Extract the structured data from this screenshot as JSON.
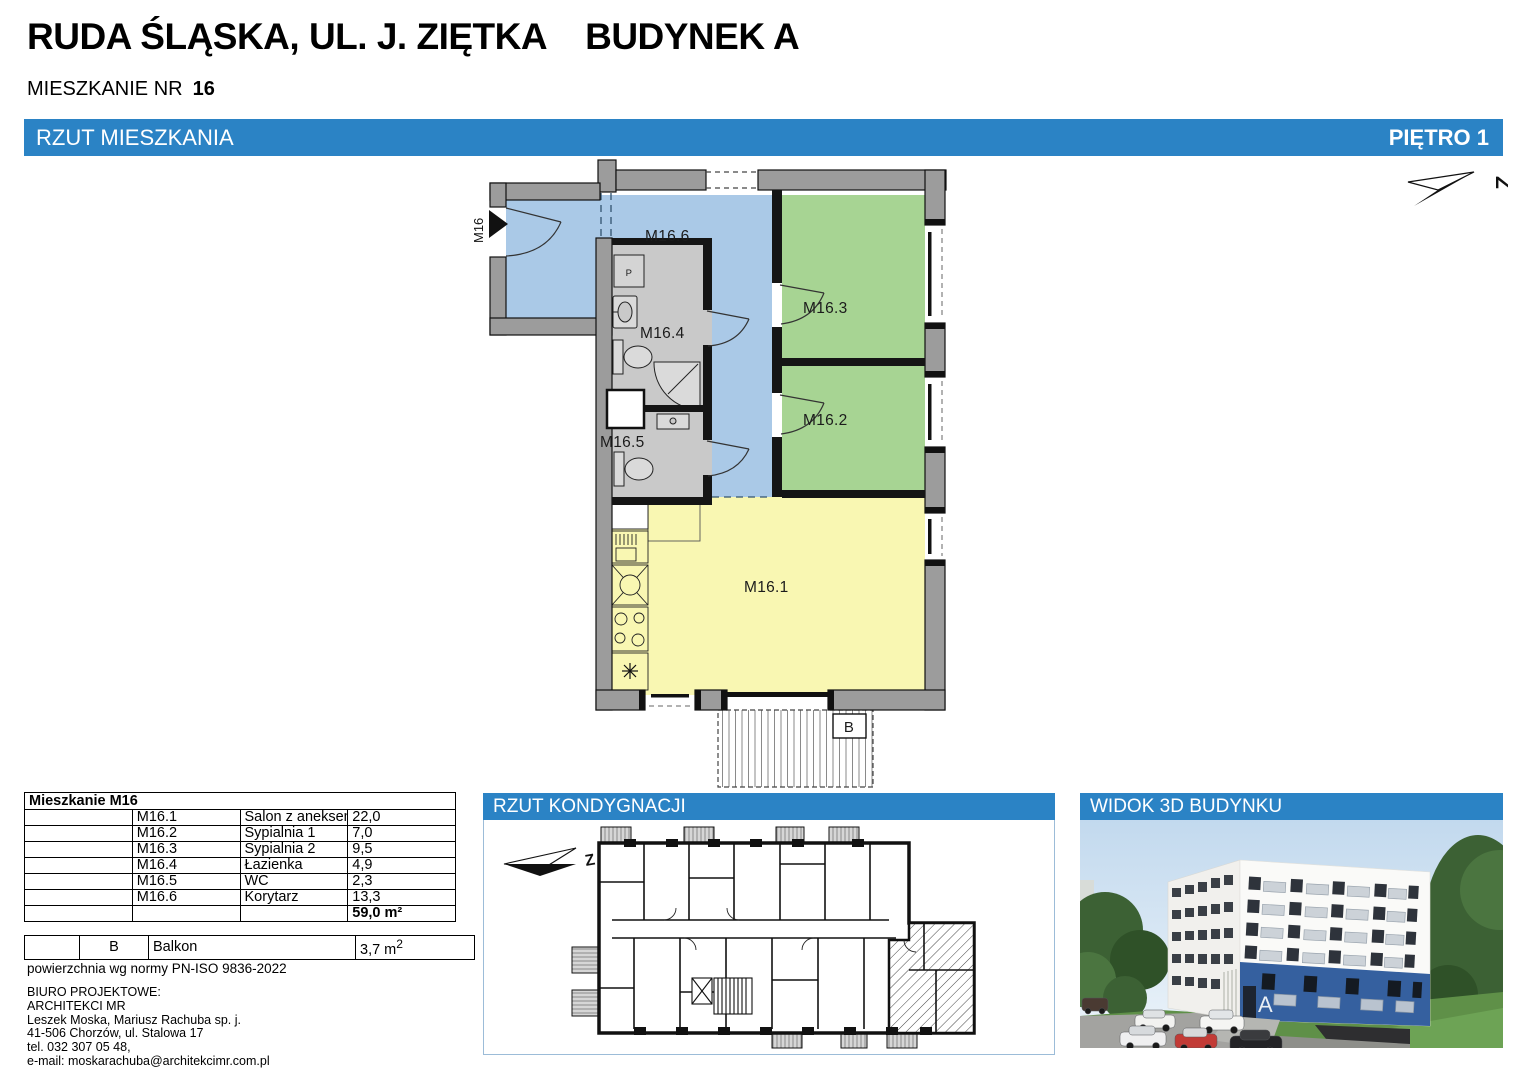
{
  "header": {
    "title_left": "RUDA ŚLĄSKA, UL. J. ZIĘTKA",
    "title_right": "BUDYNEK A",
    "apt_label": "MIESZKANIE NR",
    "apt_number": "16"
  },
  "bar": {
    "left": "RZUT MIESZKANIA",
    "right": "PIĘTRO 1"
  },
  "panels": {
    "floor_title": "RZUT KONDYGNACJI",
    "view3d_title": "WIDOK 3D BUDYNKU"
  },
  "plan": {
    "entrance": "M16",
    "washer": "P",
    "balcony": "B",
    "compass": "Z",
    "rooms": {
      "m1": "M16.1",
      "m2": "M16.2",
      "m3": "M16.3",
      "m4": "M16.4",
      "m5": "M16.5",
      "m6": "M16.6"
    }
  },
  "floorplan": {
    "compass": "Z"
  },
  "building": {
    "letter": "A"
  },
  "area_table": {
    "title": "Mieszkanie M16",
    "rows": [
      {
        "code": "M16.1",
        "name": "Salon z aneksem kuchennym",
        "area": "22,0"
      },
      {
        "code": "M16.2",
        "name": "Sypialnia 1",
        "area": "7,0"
      },
      {
        "code": "M16.3",
        "name": "Sypialnia 2",
        "area": "9,5"
      },
      {
        "code": "M16.4",
        "name": "Łazienka",
        "area": "4,9"
      },
      {
        "code": "M16.5",
        "name": "WC",
        "area": "2,3"
      },
      {
        "code": "M16.6",
        "name": "Korytarz",
        "area": "13,3"
      }
    ],
    "total": "59,0 m²"
  },
  "balcony_table": {
    "code": "B",
    "name": "Balkon",
    "area": "3,7 m",
    "area_sup": "2"
  },
  "footer": {
    "norm": "powierzchnia wg normy PN-ISO 9836-2022",
    "lines": [
      "BIURO PROJEKTOWE:",
      "ARCHITEKCI MR",
      "Leszek Moska, Mariusz Rachuba sp. j.",
      "41-506 Chorzów, ul. Stalowa 17",
      "tel. 032 307 05 48,",
      "e-mail: moskarachuba@architekcimr.com.pl"
    ]
  },
  "colors": {
    "bar_blue": "#2b83c5",
    "corridor_blue": "#aac9e7",
    "bedroom_green": "#a7d493",
    "living_yellow": "#f9f7b2",
    "bath_gray": "#c9c9c9",
    "wall_gray": "#9c9c9c",
    "building_band_blue": "#35609f"
  }
}
